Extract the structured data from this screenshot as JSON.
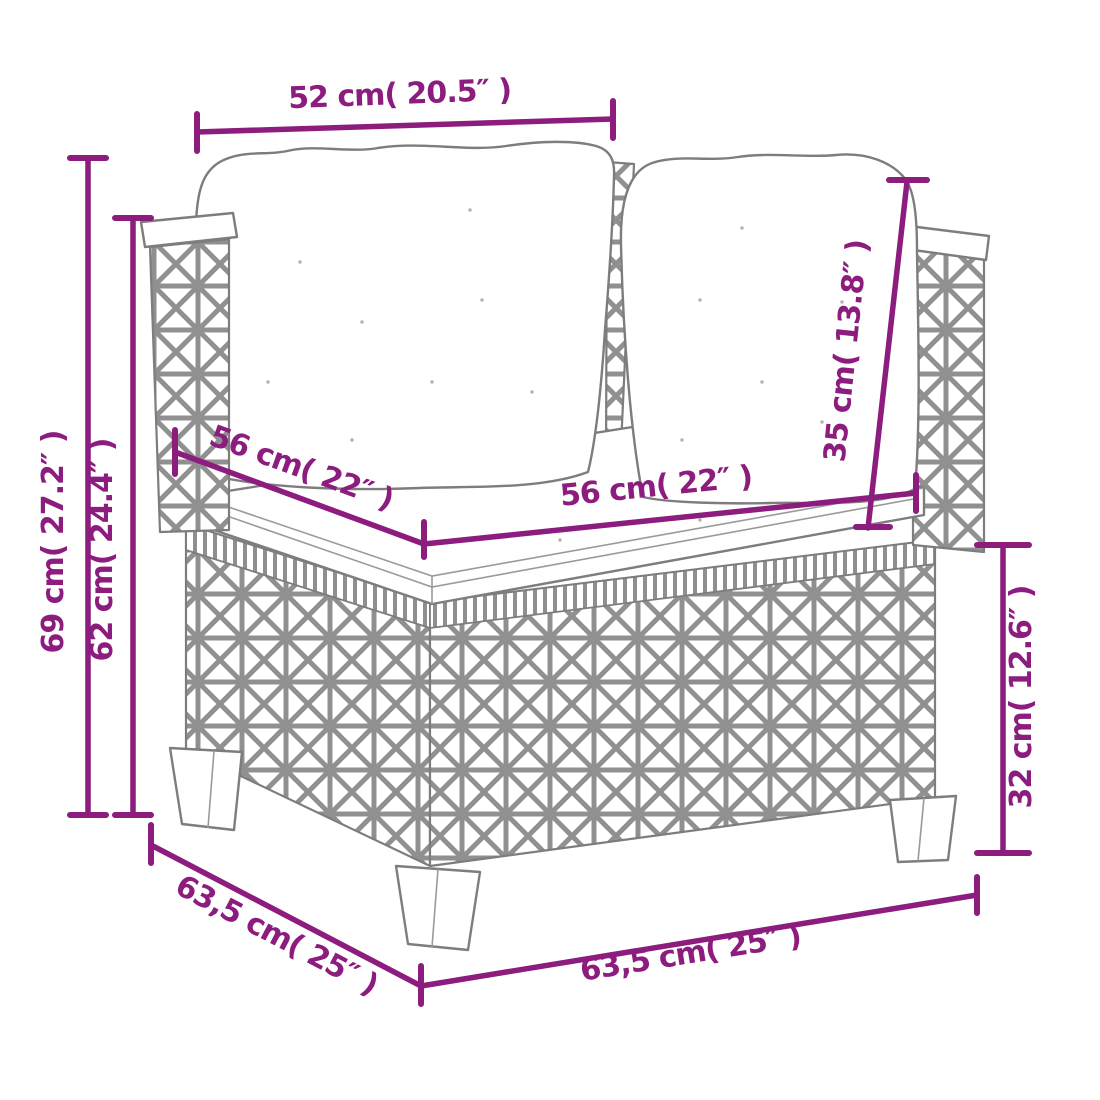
{
  "figure": {
    "kind": "product-dimension-diagram",
    "product": "rattan corner sofa section with back cushions and seat cushion",
    "background": "#FFFFFF",
    "dimension_color": "#8C1C7D",
    "sketch_line_color": "#7D7D7D"
  },
  "dimensions": {
    "back_width": "52 cm( 20.5″ )",
    "total_height": "69 cm( 27.2″ )",
    "backrest_height": "62 cm( 24.4″ )",
    "seat_depth": "56 cm( 22″ )",
    "seat_width": "56 cm( 22″ )",
    "back_cushion_height": "35 cm( 13.8″ )",
    "base_height": "32 cm( 12.6″ )",
    "total_depth": "63,5 cm( 25″ )",
    "total_width": "63,5 cm( 25″ )"
  }
}
